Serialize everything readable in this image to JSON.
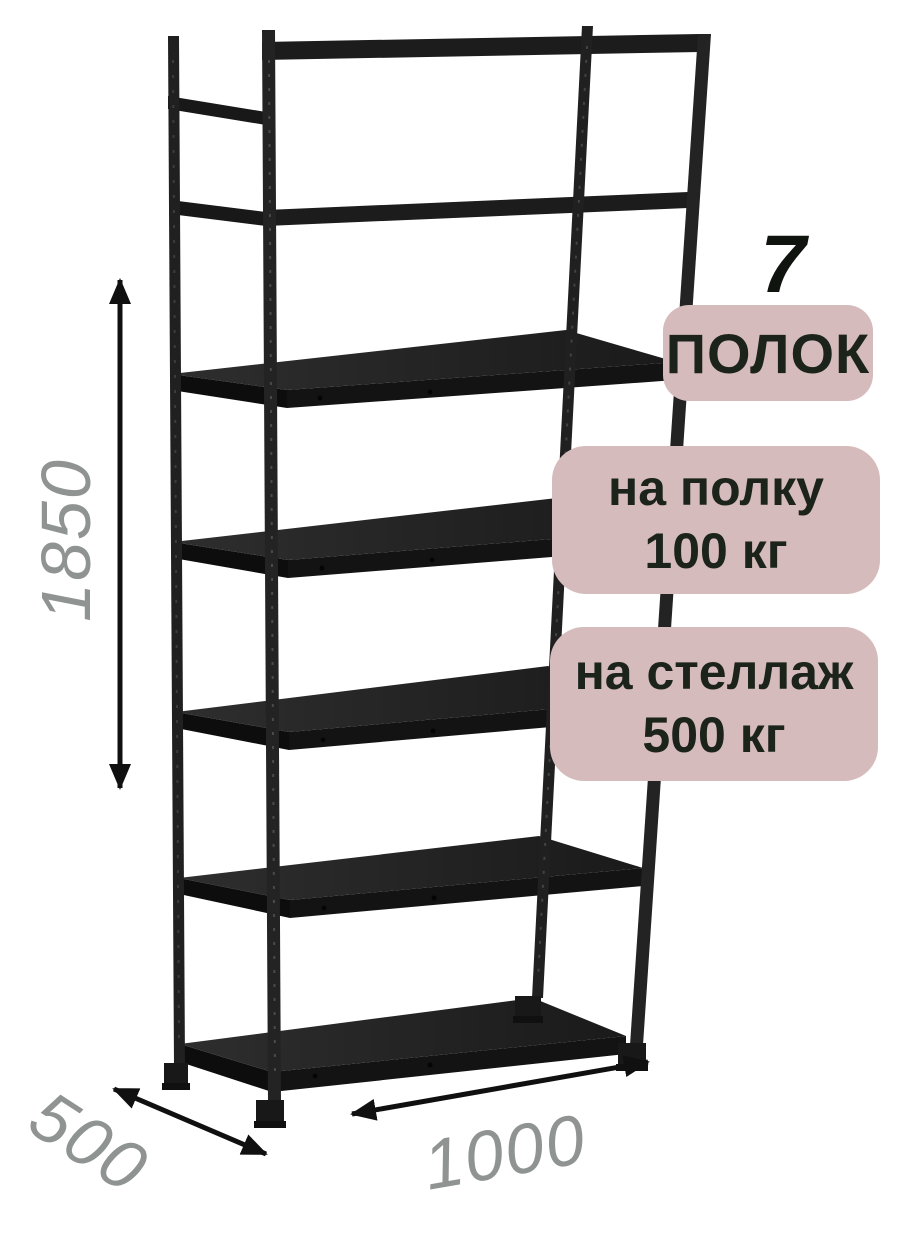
{
  "scene": {
    "background": "#ffffff",
    "subject": "metal-shelving-rack-7-shelves",
    "rack_color": "#1e1e1e",
    "shelf_count": 7
  },
  "callouts": {
    "badge_bg": "#d5bbbb",
    "badge_text_color": "#1b231b",
    "shelf_count_number": "7",
    "shelf_count_label": "ПОЛОК",
    "per_shelf_line1": "на полку",
    "per_shelf_line2": "100 кг",
    "per_rack_line1": "на стеллаж",
    "per_rack_line2": "500 кг"
  },
  "dimensions": {
    "height_mm": "1850",
    "depth_mm": "500",
    "width_mm": "1000",
    "label_color": "#8f9392",
    "arrow_color": "#101010"
  }
}
